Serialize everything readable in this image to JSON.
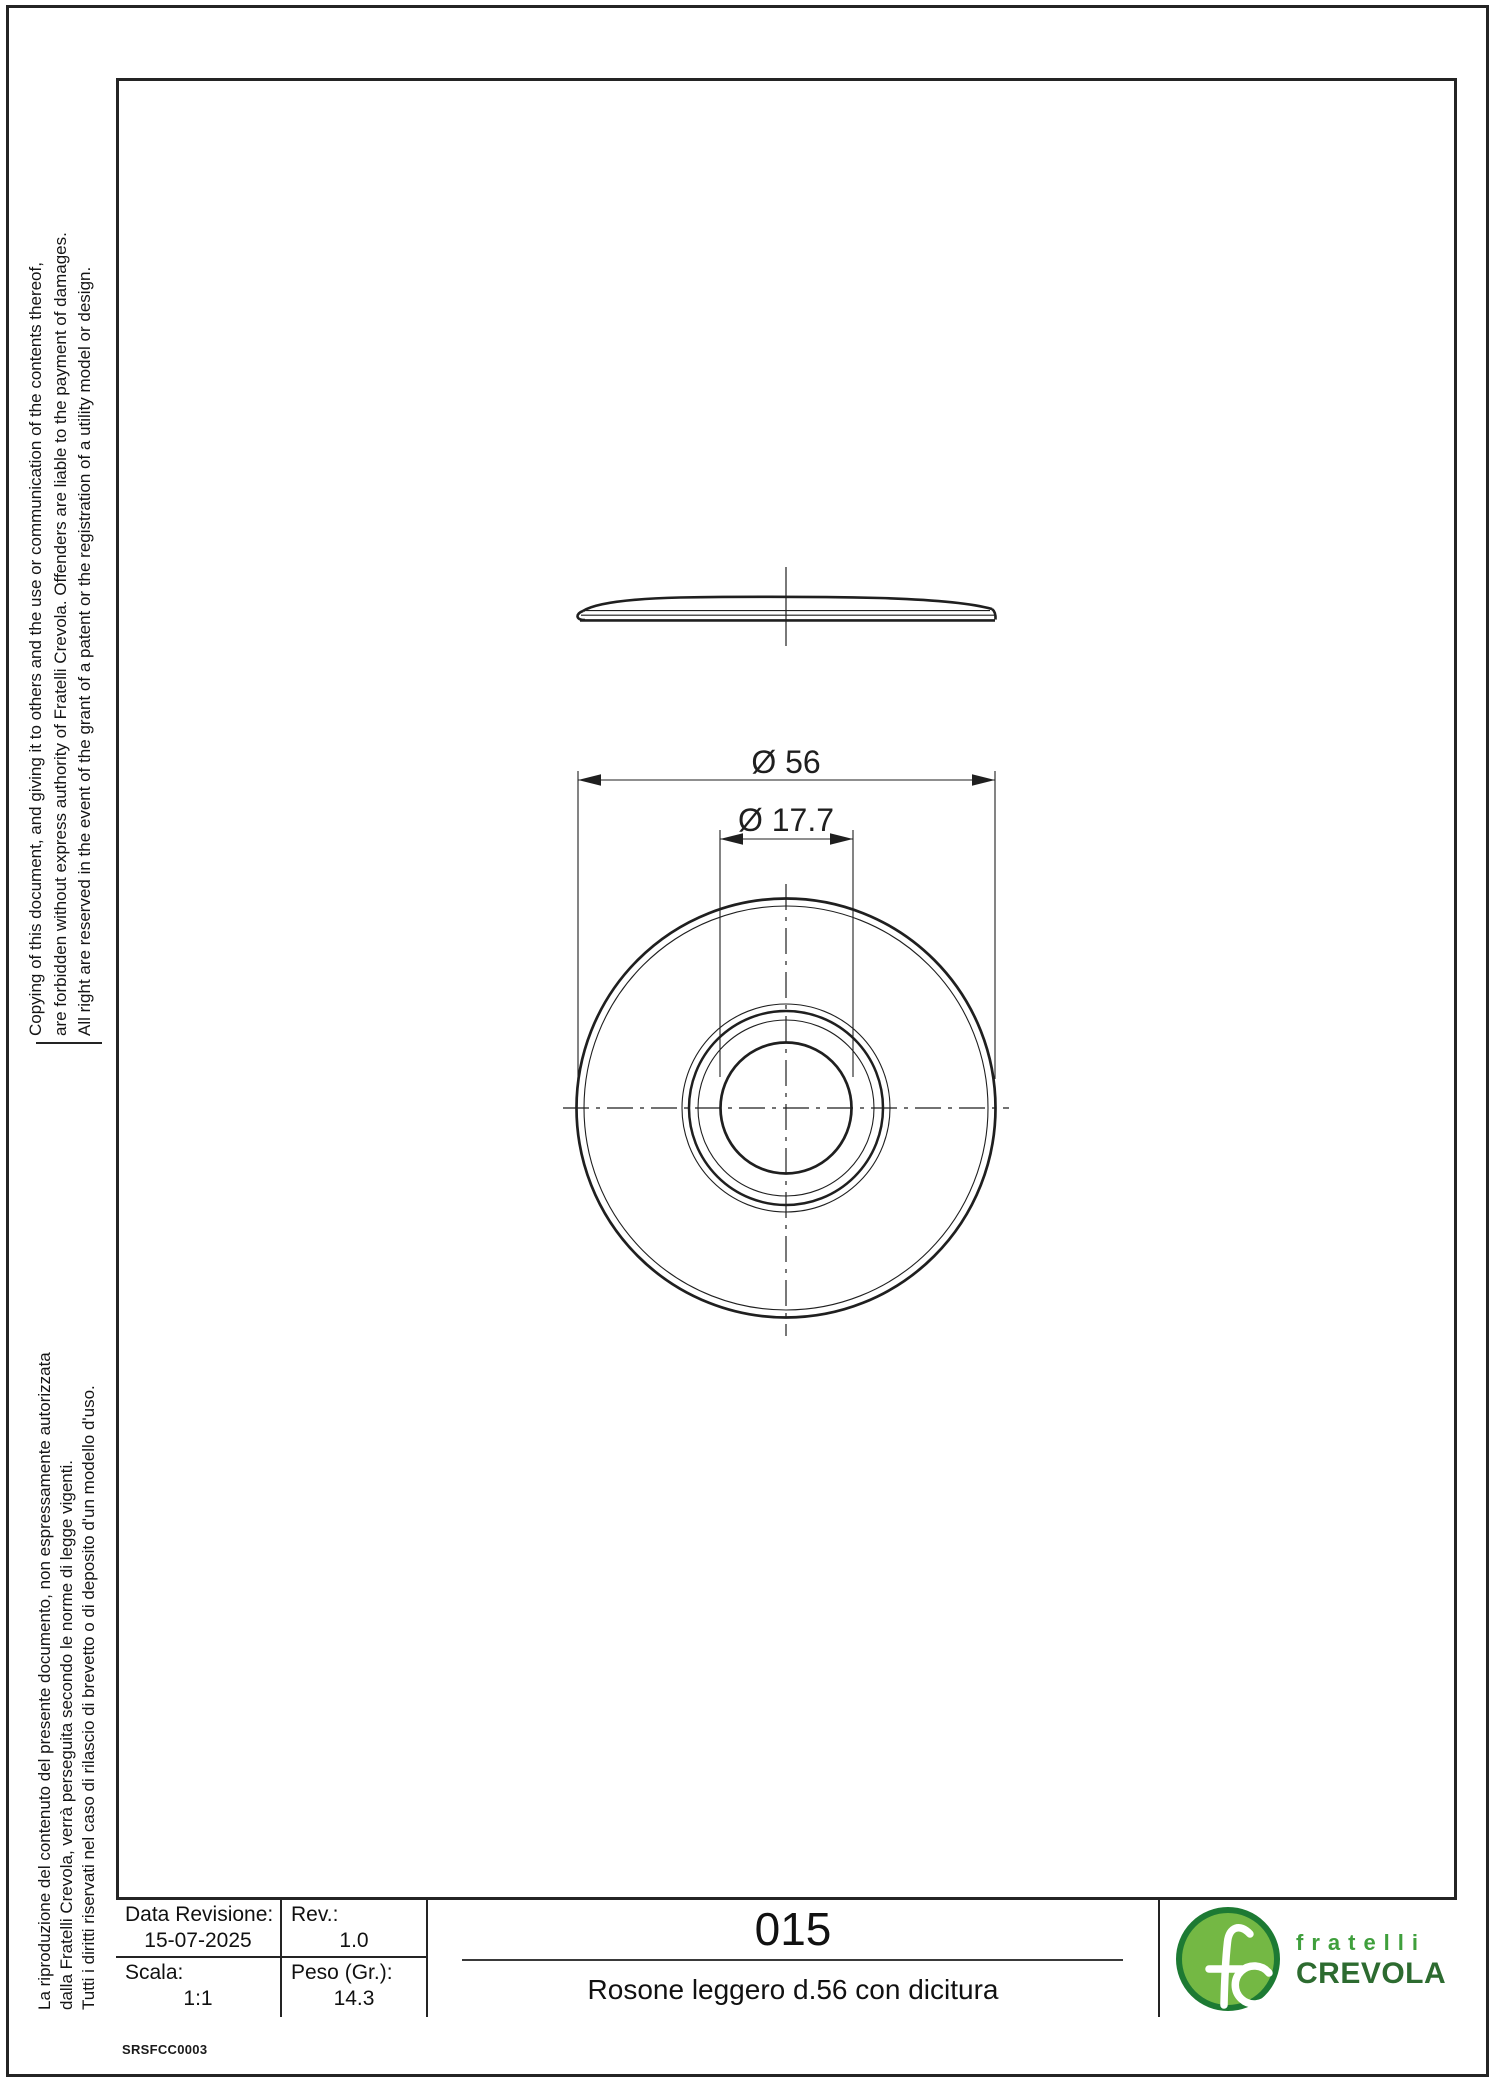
{
  "doc": {
    "code": "SRSFCC0003"
  },
  "notices": {
    "english_lines": [
      "Copying of this document, and giving it to others and the use or communication of the contents thereof,",
      "are forbidden without express authority of Fratelli Crevola. Offenders are liable to the payment of damages.",
      "All right are reserved in the event of the grant of a patent or the registration of a utility model or design."
    ],
    "italian_lines": [
      "La riproduzione del contenuto del presente documento, non espressamente autorizzata",
      "dalla Fratelli Crevola, verrà perseguita secondo le norme di legge vigenti.",
      "Tutti i diritti riservati nel caso di rilascio di brevetto o di deposito d'un modello d'uso."
    ]
  },
  "drawing": {
    "dim_outer_label": "Ø 56",
    "dim_inner_label": "Ø 17.7"
  },
  "title_block": {
    "data_revisione_label": "Data Revisione:",
    "data_revisione_value": "15-07-2025",
    "rev_label": "Rev.:",
    "rev_value": "1.0",
    "scala_label": "Scala:",
    "scala_value": "1:1",
    "peso_label": "Peso (Gr.):",
    "peso_value": "14.3",
    "part_number": "015",
    "part_name": "Rosone leggero d.56 con dicitura"
  },
  "logo": {
    "name_line1": "fratelli",
    "name_line2": "CREVOLA",
    "colors": {
      "ring": "#1d7a33",
      "fill": "#74b844",
      "line1": "#3f9f3c",
      "line2": "#2d6b30"
    }
  }
}
